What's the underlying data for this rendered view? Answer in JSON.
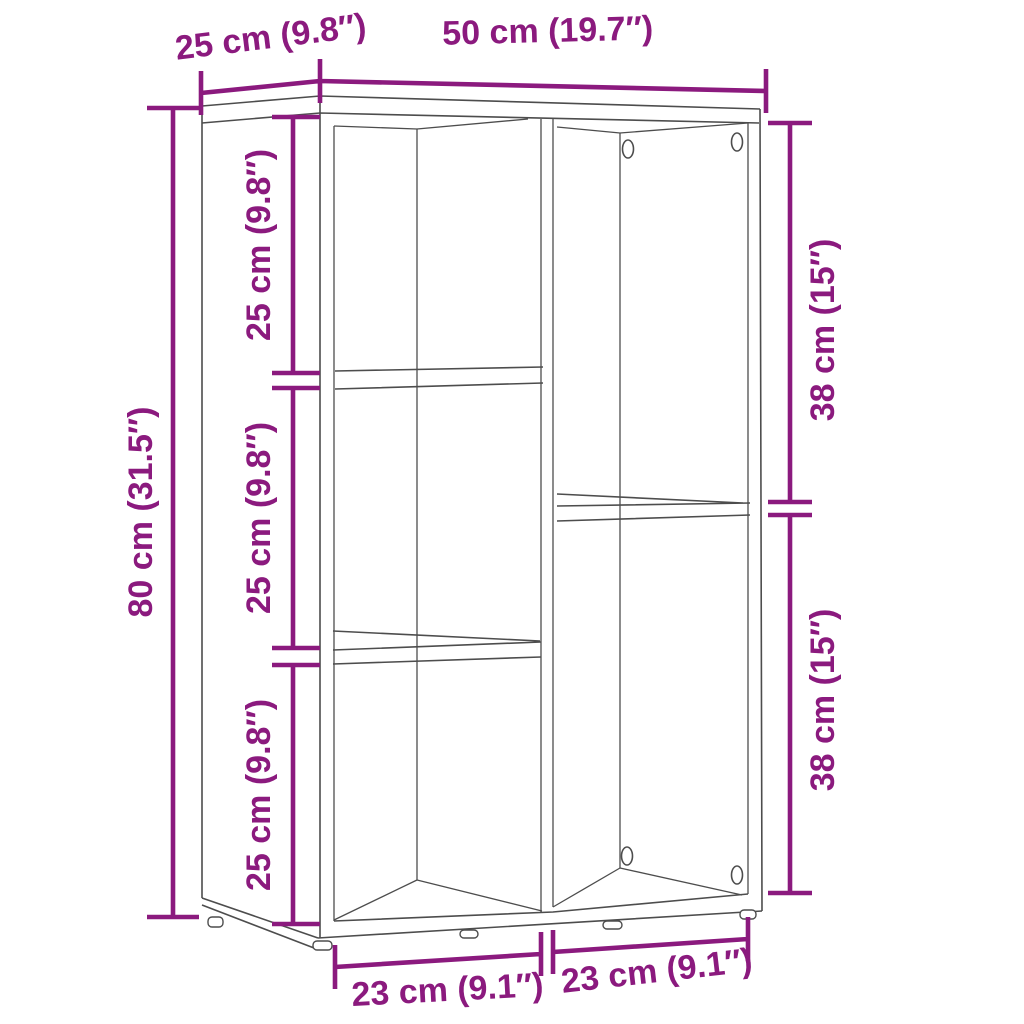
{
  "diagram": {
    "kind": "furniture-dimension-diagram",
    "subject": "5-cube open book cabinet, perspective line drawing with measurements"
  },
  "colors": {
    "dimension": "#8B1A7E",
    "outline": "#4D4D4D",
    "background": "#FFFFFF"
  },
  "labels": {
    "top_depth": "25 cm (9.8″)",
    "top_width": "50 cm (19.7″)",
    "left_height": "80 cm (31.5″)",
    "inner_compartment_top": "25 cm (9.8″)",
    "inner_compartment_middle": "25 cm (9.8″)",
    "inner_compartment_bottom": "25 cm (9.8″)",
    "right_compartment_upper": "38 cm (15″)",
    "right_compartment_lower": "38 cm (15″)",
    "bottom_width_left": "23 cm (9.1″)",
    "bottom_width_right": "23 cm (9.1″)"
  }
}
